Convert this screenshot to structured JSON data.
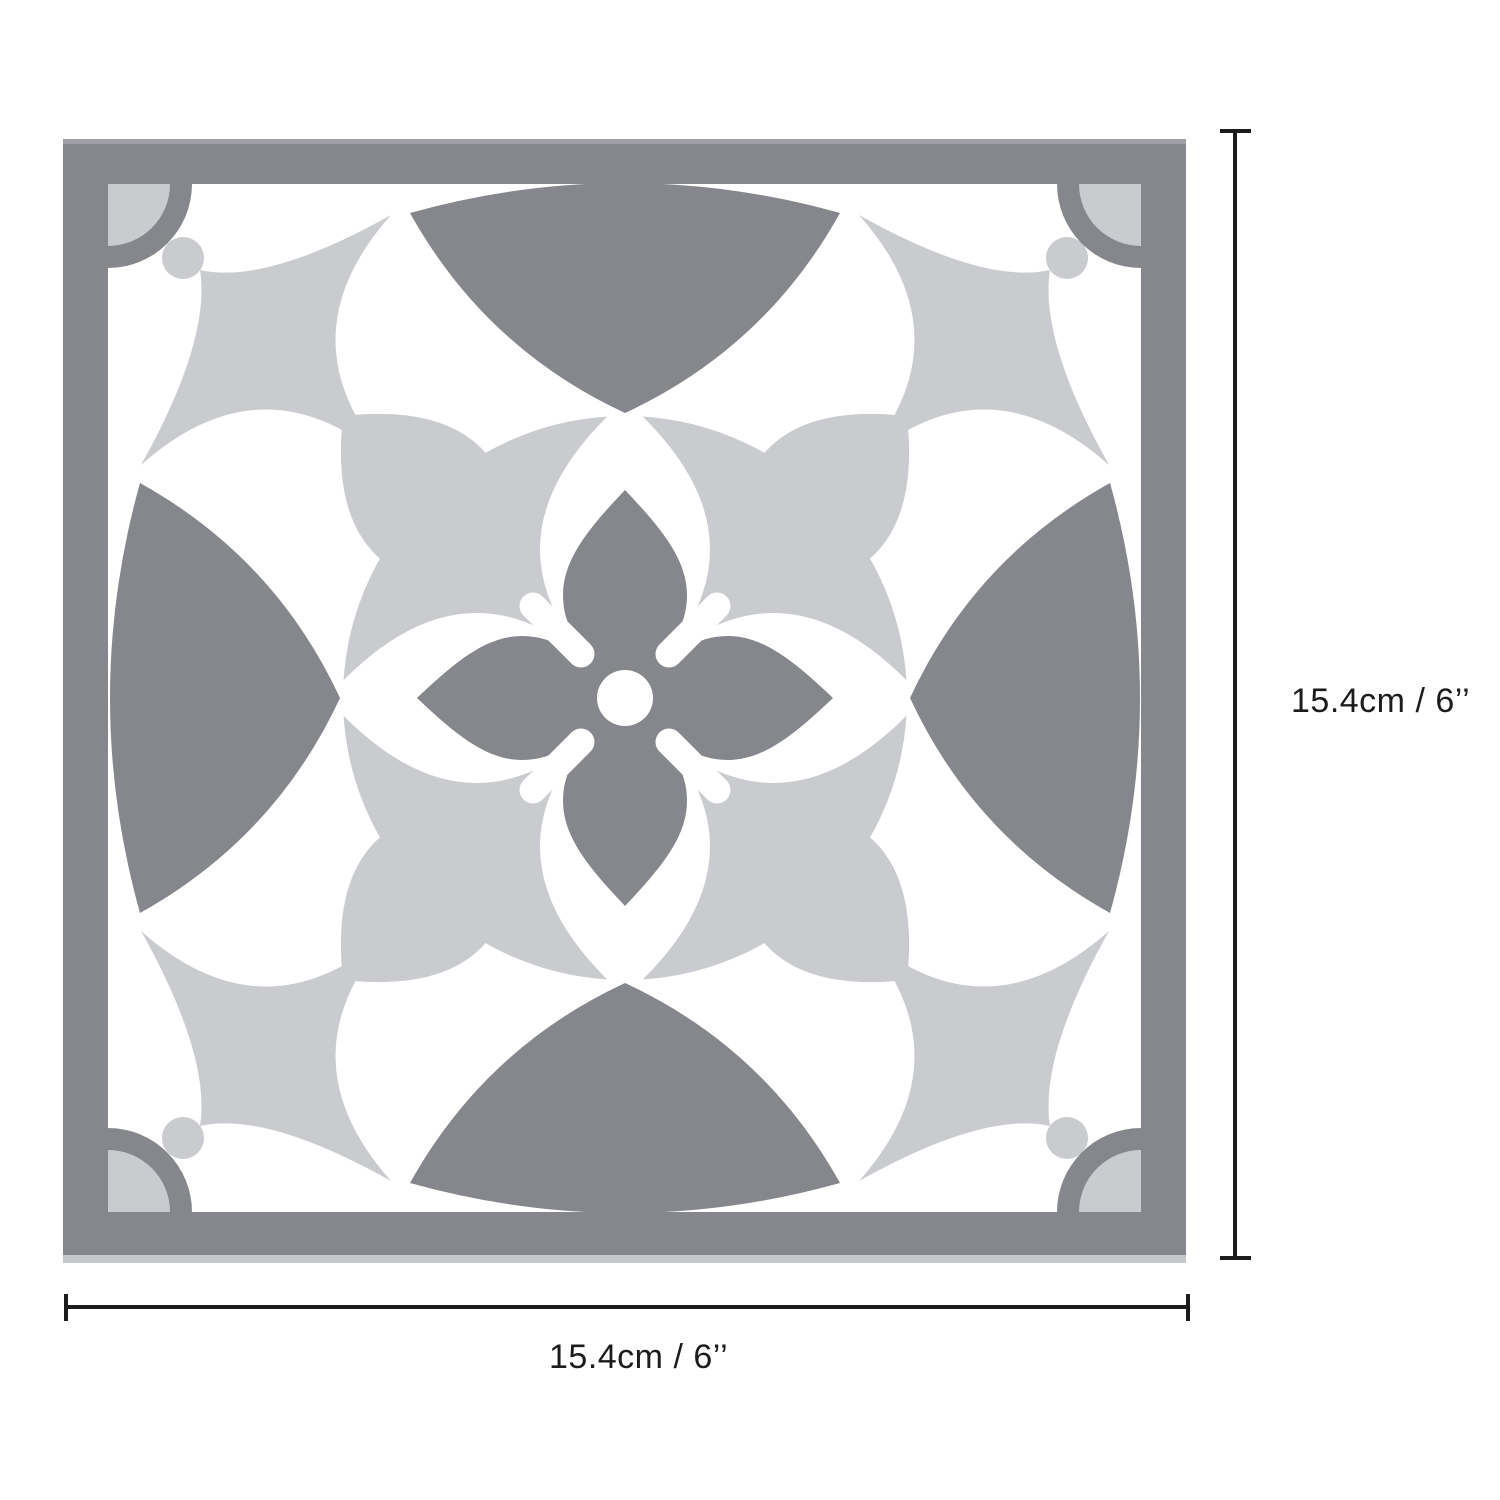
{
  "diagram": {
    "subject": "decorative-tile-with-dimensions",
    "labels": {
      "height": "15.4cm / 6’’",
      "width": "15.4cm / 6’’"
    }
  },
  "colors": {
    "background": "#FFFFFF",
    "tile_dark_gray": "#85878C",
    "tile_light_gray": "#C9CBCE",
    "tile_white": "#FFFFFF",
    "frame_top_highlight": "#9EA0A5",
    "frame_bottom_shadow": "#C6C7CA",
    "dimension_ink": "#1C1C1C"
  },
  "icons": {
    "tile_motifs": [
      "frame-border",
      "corner-quarter-fan",
      "quadrant-four-point-star",
      "edge-curved-triangle-fan",
      "center-circle-rosette",
      "diagonal-leaf",
      "four-petal-flower"
    ]
  }
}
